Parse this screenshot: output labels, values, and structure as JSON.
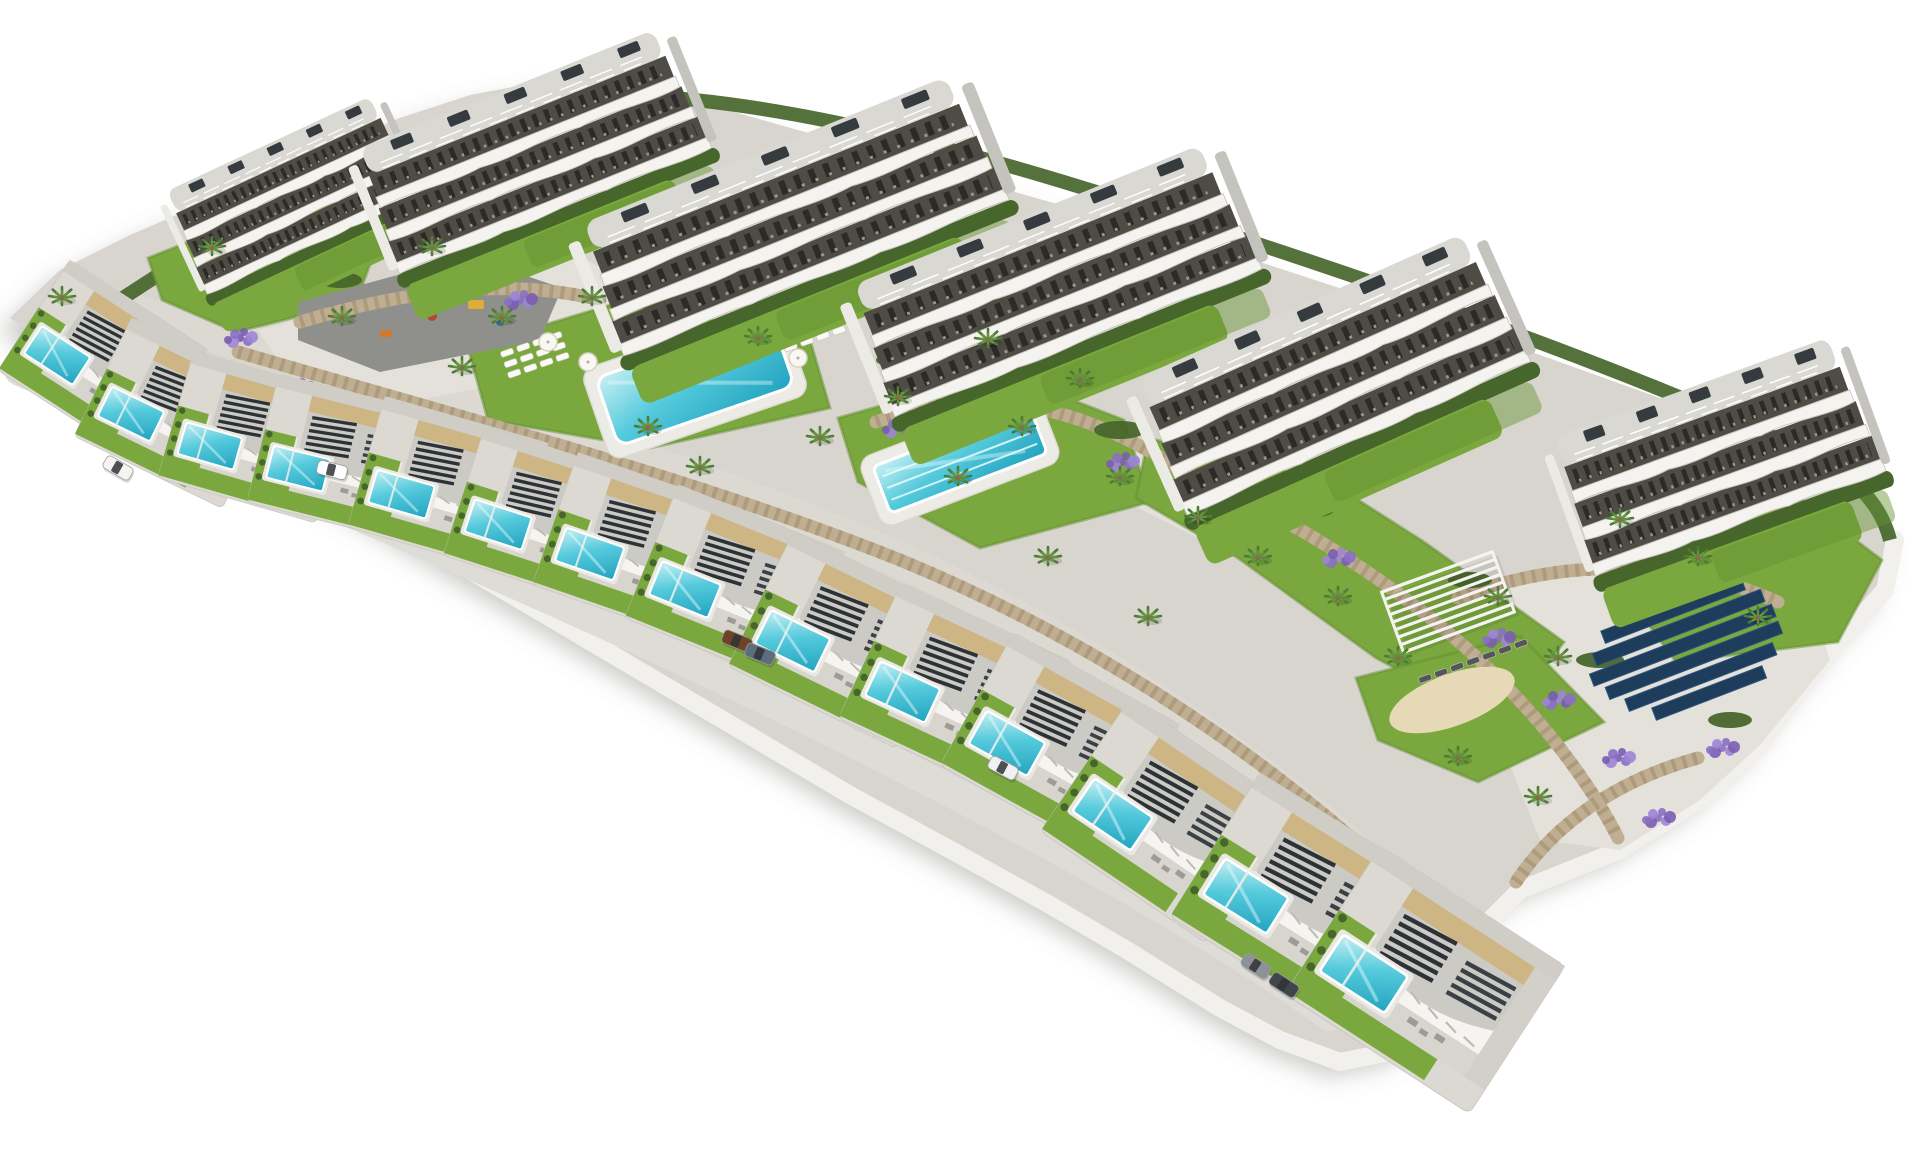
{
  "scene": {
    "canvas": {
      "w": 1920,
      "h": 1152,
      "background": "#ffffff"
    },
    "palette": {
      "land": "#d7d5ce",
      "road": "#dbd9d2",
      "road2": "#dedcd6",
      "plaza": "#e3e1da",
      "rim": "#f1f0ec",
      "building_white": "#f4f3ef",
      "band_dark": "#4f4c46",
      "roof_gray": "#d9d8d2",
      "roof_box": "#363b40",
      "villa_roof": "#cbcac4",
      "beige": "#cdb584",
      "pergola_dark": "#2d3236",
      "lawn": "#7aa83e",
      "lawn_dark": "#63902f",
      "hedge": "#47662b",
      "stone": "#bfae92",
      "stone_dark": "#a3916f",
      "lavender": "#8b6fc4",
      "lavender2": "#9d85d6",
      "lavender3": "#7a5db3",
      "pool_light": "#c8f0f4",
      "pool_mid": "#55cadc",
      "pool_deep": "#21a3bf",
      "asphalt": "#8f8f8c",
      "sand": "#e6d9b5",
      "solar": "#1e3c5c",
      "solar_edge": "#2d557e",
      "palm": "#4e7c33",
      "palm_light": "#6a9a44",
      "trunk": "#8a6a4a",
      "shadow": "#75736d"
    },
    "land_outline": [
      [
        10,
        318
      ],
      [
        60,
        270
      ],
      [
        130,
        235
      ],
      [
        200,
        205
      ],
      [
        300,
        160
      ],
      [
        400,
        118
      ],
      [
        470,
        95
      ],
      [
        540,
        82
      ],
      [
        620,
        88
      ],
      [
        720,
        108
      ],
      [
        840,
        142
      ],
      [
        980,
        182
      ],
      [
        1120,
        222
      ],
      [
        1260,
        262
      ],
      [
        1400,
        308
      ],
      [
        1540,
        355
      ],
      [
        1660,
        398
      ],
      [
        1780,
        445
      ],
      [
        1862,
        492
      ],
      [
        1895,
        540
      ],
      [
        1885,
        590
      ],
      [
        1840,
        640
      ],
      [
        1800,
        690
      ],
      [
        1760,
        745
      ],
      [
        1700,
        800
      ],
      [
        1620,
        850
      ],
      [
        1520,
        890
      ],
      [
        1470,
        940
      ],
      [
        1440,
        1000
      ],
      [
        1400,
        1050
      ],
      [
        1340,
        1062
      ],
      [
        1280,
        1040
      ],
      [
        1220,
        1008
      ],
      [
        1130,
        952
      ],
      [
        1050,
        905
      ],
      [
        960,
        855
      ],
      [
        850,
        795
      ],
      [
        740,
        730
      ],
      [
        630,
        665
      ],
      [
        520,
        600
      ],
      [
        410,
        535
      ],
      [
        300,
        470
      ],
      [
        195,
        408
      ],
      [
        110,
        360
      ],
      [
        45,
        340
      ]
    ],
    "rim_path": "M 1895,540 L 1885,590 L 1840,640 L 1800,690 L 1760,745 L 1700,800 L 1620,850 L 1520,890 L 1470,940 L 1440,1000 L 1400,1050 L 1340,1062 L 1280,1040 L 1220,1008 L 1130,952 L 1050,905 L 960,855 L 850,795 L 740,730 L 630,665 L 520,600 L 410,535 L 300,470 L 195,408 L 110,360 L 45,340",
    "hedge_top": "M 120,300 C 300,180 480,100 620,95 C 800,100 1000,160 1200,225 C 1400,290 1600,360 1780,440 C 1850,470 1880,500 1890,540",
    "roads": {
      "upper": "M 90,300 C 300,360 600,430 900,560 C 1100,650 1300,790 1430,920",
      "front": "M 20,370 C 250,470 550,590 850,740 C 1050,840 1220,935 1330,1015",
      "plaza": [
        [
          258,
          330
        ],
        [
          560,
          248
        ],
        [
          650,
          290
        ],
        [
          618,
          360
        ],
        [
          420,
          400
        ],
        [
          278,
          360
        ]
      ],
      "junction": [
        [
          1096,
          430
        ],
        [
          1300,
          498
        ],
        [
          1420,
          558
        ],
        [
          1378,
          620
        ],
        [
          1238,
          558
        ],
        [
          1078,
          478
        ]
      ],
      "solar_pad": [
        [
          1500,
          580
        ],
        [
          1700,
          560
        ],
        [
          1810,
          600
        ],
        [
          1830,
          660
        ],
        [
          1760,
          745
        ],
        [
          1700,
          800
        ],
        [
          1620,
          850
        ],
        [
          1540,
          840
        ],
        [
          1500,
          740
        ],
        [
          1480,
          650
        ]
      ]
    },
    "lawns": [
      {
        "name": "pool-a-lawn",
        "pts": [
          [
            468,
            348
          ],
          [
            620,
            302
          ],
          [
            810,
            340
          ],
          [
            830,
            408
          ],
          [
            650,
            448
          ],
          [
            488,
            420
          ]
        ]
      },
      {
        "name": "lap-pool-lawn",
        "pts": [
          [
            838,
            418
          ],
          [
            1000,
            372
          ],
          [
            1124,
            420
          ],
          [
            1150,
            502
          ],
          [
            980,
            548
          ],
          [
            858,
            482
          ]
        ]
      },
      {
        "name": "east-lawn",
        "pts": [
          [
            1148,
            438
          ],
          [
            1330,
            482
          ],
          [
            1424,
            542
          ],
          [
            1564,
            642
          ],
          [
            1500,
            724
          ],
          [
            1376,
            658
          ],
          [
            1238,
            558
          ],
          [
            1136,
            498
          ]
        ]
      },
      {
        "name": "sand-lawn",
        "pts": [
          [
            1356,
            678
          ],
          [
            1520,
            636
          ],
          [
            1604,
            722
          ],
          [
            1478,
            782
          ],
          [
            1378,
            740
          ]
        ]
      },
      {
        "name": "b6-garden-lawn",
        "pts": [
          [
            1598,
            556
          ],
          [
            1800,
            498
          ],
          [
            1882,
            560
          ],
          [
            1838,
            642
          ],
          [
            1676,
            662
          ]
        ]
      },
      {
        "name": "b1-west-lawn",
        "pts": [
          [
            148,
            258
          ],
          [
            320,
            190
          ],
          [
            382,
            232
          ],
          [
            356,
            302
          ],
          [
            236,
            332
          ],
          [
            162,
            300
          ]
        ]
      }
    ],
    "walls": [
      "M 238,352 C 470,420 700,480 900,560 C 1080,634 1258,748 1396,878",
      "M 876,422 C 1000,378 1098,418 1178,468",
      "M 1180,470 C 1300,520 1420,600 1498,678 C 1558,738 1598,798 1618,838",
      "M 1458,598 C 1560,558 1680,558 1778,602",
      "M 196,392 C 152,362 116,342 58,330",
      "M 1516,882 C 1556,822 1618,780 1698,758",
      "M 300,322 C 420,286 520,280 600,300"
    ],
    "lavender": [
      [
        298,
        388
      ],
      [
        418,
        428
      ],
      [
        556,
        468
      ],
      [
        698,
        518
      ],
      [
        838,
        578
      ],
      [
        958,
        638
      ],
      [
        1078,
        698
      ],
      [
        1198,
        778
      ],
      [
        1298,
        848
      ],
      [
        520,
        300
      ],
      [
        760,
        352
      ],
      [
        898,
        428
      ],
      [
        1498,
        638
      ],
      [
        1558,
        700
      ],
      [
        1618,
        758
      ],
      [
        1238,
        498
      ],
      [
        1338,
        558
      ],
      [
        240,
        338
      ],
      [
        1658,
        818
      ],
      [
        1416,
        896
      ],
      [
        1122,
        462
      ],
      [
        1722,
        748
      ]
    ],
    "hedge_blobs": [
      [
        652,
        300,
        26,
        9
      ],
      [
        900,
        360,
        24,
        8
      ],
      [
        1120,
        430,
        26,
        9
      ],
      [
        1310,
        510,
        24,
        8
      ],
      [
        1470,
        580,
        22,
        8
      ],
      [
        340,
        280,
        22,
        8
      ],
      [
        1600,
        660,
        24,
        8
      ],
      [
        1730,
        720,
        22,
        8
      ]
    ],
    "buildings": [
      {
        "x": 300,
        "y": 212,
        "sx": 0.6,
        "sy": 0.8,
        "rot": -25
      },
      {
        "x": 540,
        "y": 172,
        "sx": 0.85,
        "sy": 0.95,
        "rot": -22
      },
      {
        "x": 800,
        "y": 237,
        "sx": 1.05,
        "sy": 1.0,
        "rot": -22
      },
      {
        "x": 1062,
        "y": 302,
        "sx": 1.0,
        "sy": 1.0,
        "rot": -22
      },
      {
        "x": 1340,
        "y": 396,
        "sx": 0.95,
        "sy": 1.05,
        "rot": -24
      },
      {
        "x": 1725,
        "y": 480,
        "sx": 0.78,
        "sy": 1.05,
        "rot": -20
      }
    ],
    "villas": [
      {
        "x": 103,
        "y": 360,
        "rot": 33,
        "s": 0.66
      },
      {
        "x": 177,
        "y": 413,
        "rot": 26,
        "s": 0.66
      },
      {
        "x": 255,
        "y": 437,
        "rot": 16,
        "s": 0.66
      },
      {
        "x": 343,
        "y": 458,
        "rot": 14,
        "s": 0.66
      },
      {
        "x": 448,
        "y": 485,
        "rot": 16,
        "s": 0.68
      },
      {
        "x": 545,
        "y": 517,
        "rot": 18,
        "s": 0.68
      },
      {
        "x": 638,
        "y": 547,
        "rot": 19,
        "s": 0.7
      },
      {
        "x": 735,
        "y": 585,
        "rot": 22,
        "s": 0.72
      },
      {
        "x": 845,
        "y": 640,
        "rot": 26,
        "s": 0.75
      },
      {
        "x": 955,
        "y": 690,
        "rot": 25,
        "s": 0.75
      },
      {
        "x": 1060,
        "y": 745,
        "rot": 29,
        "s": 0.76
      },
      {
        "x": 1168,
        "y": 821,
        "rot": 34,
        "s": 0.8
      },
      {
        "x": 1305,
        "y": 901,
        "rot": 32,
        "s": 0.85
      },
      {
        "x": 1425,
        "y": 980,
        "rot": 33,
        "s": 0.88
      }
    ],
    "pools": {
      "communal": {
        "x": 695,
        "y": 382,
        "w": 186,
        "h": 72,
        "rot": -19,
        "lanes": 0
      },
      "lap": {
        "x": 960,
        "y": 460,
        "w": 168,
        "h": 50,
        "rot": -21,
        "lanes": 3
      }
    },
    "solar": {
      "x": 1585,
      "y": 618,
      "rot": -21,
      "pitch": 18,
      "rows": [
        {
          "dx": 36,
          "len": 110
        },
        {
          "dx": 10,
          "len": 150
        },
        {
          "dx": -6,
          "len": 180
        },
        {
          "dx": -16,
          "len": 195
        },
        {
          "dx": -6,
          "len": 185
        },
        {
          "dx": 8,
          "len": 158
        },
        {
          "dx": 30,
          "len": 118
        }
      ]
    },
    "pergola": {
      "x": 1448,
      "y": 602,
      "rot": -20,
      "w": 118,
      "h": 64,
      "slats": 9
    },
    "sand": {
      "x": 1452,
      "y": 700,
      "rx": 66,
      "ry": 26,
      "rot": -20
    },
    "playground": {
      "pts": [
        [
          298,
          302
        ],
        [
          468,
          256
        ],
        [
          562,
          288
        ],
        [
          540,
          340
        ],
        [
          380,
          372
        ],
        [
          298,
          340
        ]
      ],
      "items": [
        {
          "t": "rect",
          "x": 468,
          "y": 300,
          "w": 16,
          "h": 9,
          "c": "#dfae36"
        },
        {
          "t": "dot",
          "x": 432,
          "y": 316,
          "r": 5,
          "c": "#b8452e"
        },
        {
          "t": "dot",
          "x": 500,
          "y": 322,
          "r": 4,
          "c": "#3a6ea8"
        },
        {
          "t": "rect",
          "x": 380,
          "y": 330,
          "w": 12,
          "h": 7,
          "c": "#cf7a2c"
        }
      ]
    },
    "loungers": [
      {
        "x": 500,
        "y": 352,
        "rot": -19,
        "rows": 3,
        "cols": 4,
        "dark": false
      },
      {
        "x": 780,
        "y": 336,
        "rot": -19,
        "rows": 2,
        "cols": 4,
        "dark": false
      },
      {
        "x": 912,
        "y": 396,
        "rot": -21,
        "rows": 1,
        "cols": 5,
        "dark": false
      },
      {
        "x": 1418,
        "y": 678,
        "rot": -20,
        "rows": 1,
        "cols": 7,
        "dark": true
      },
      {
        "x": 1636,
        "y": 596,
        "rot": -20,
        "rows": 1,
        "cols": 4,
        "dark": false
      }
    ],
    "umbrellas": [
      [
        548,
        342
      ],
      [
        588,
        362
      ],
      [
        756,
        338
      ],
      [
        798,
        358
      ],
      [
        946,
        392
      ],
      [
        622,
        330
      ]
    ],
    "palms": [
      [
        212,
        248
      ],
      [
        432,
        248
      ],
      [
        502,
        318
      ],
      [
        592,
        298
      ],
      [
        648,
        428
      ],
      [
        758,
        338
      ],
      [
        820,
        438
      ],
      [
        898,
        398
      ],
      [
        958,
        478
      ],
      [
        1022,
        428
      ],
      [
        1120,
        478
      ],
      [
        1198,
        518
      ],
      [
        1258,
        558
      ],
      [
        1338,
        598
      ],
      [
        1398,
        658
      ],
      [
        1498,
        598
      ],
      [
        1558,
        658
      ],
      [
        1698,
        558
      ],
      [
        1758,
        618
      ],
      [
        462,
        368
      ],
      [
        342,
        318
      ],
      [
        700,
        468
      ],
      [
        1048,
        558
      ],
      [
        1148,
        618
      ],
      [
        62,
        298
      ],
      [
        1458,
        758
      ],
      [
        1538,
        798
      ],
      [
        1620,
        520
      ],
      [
        988,
        340
      ],
      [
        1080,
        380
      ]
    ],
    "cars": [
      {
        "x": 118,
        "y": 468,
        "rot": 30,
        "c": "#f4f4f2"
      },
      {
        "x": 332,
        "y": 470,
        "rot": 14,
        "c": "#ffffff"
      },
      {
        "x": 737,
        "y": 641,
        "rot": 22,
        "c": "#6e4226"
      },
      {
        "x": 760,
        "y": 654,
        "rot": 22,
        "c": "#5d6d7d"
      },
      {
        "x": 1003,
        "y": 768,
        "rot": 28,
        "c": "#f0f1f3"
      },
      {
        "x": 1256,
        "y": 966,
        "rot": 33,
        "c": "#8d9299"
      },
      {
        "x": 1284,
        "y": 985,
        "rot": 33,
        "c": "#41464d"
      }
    ]
  }
}
